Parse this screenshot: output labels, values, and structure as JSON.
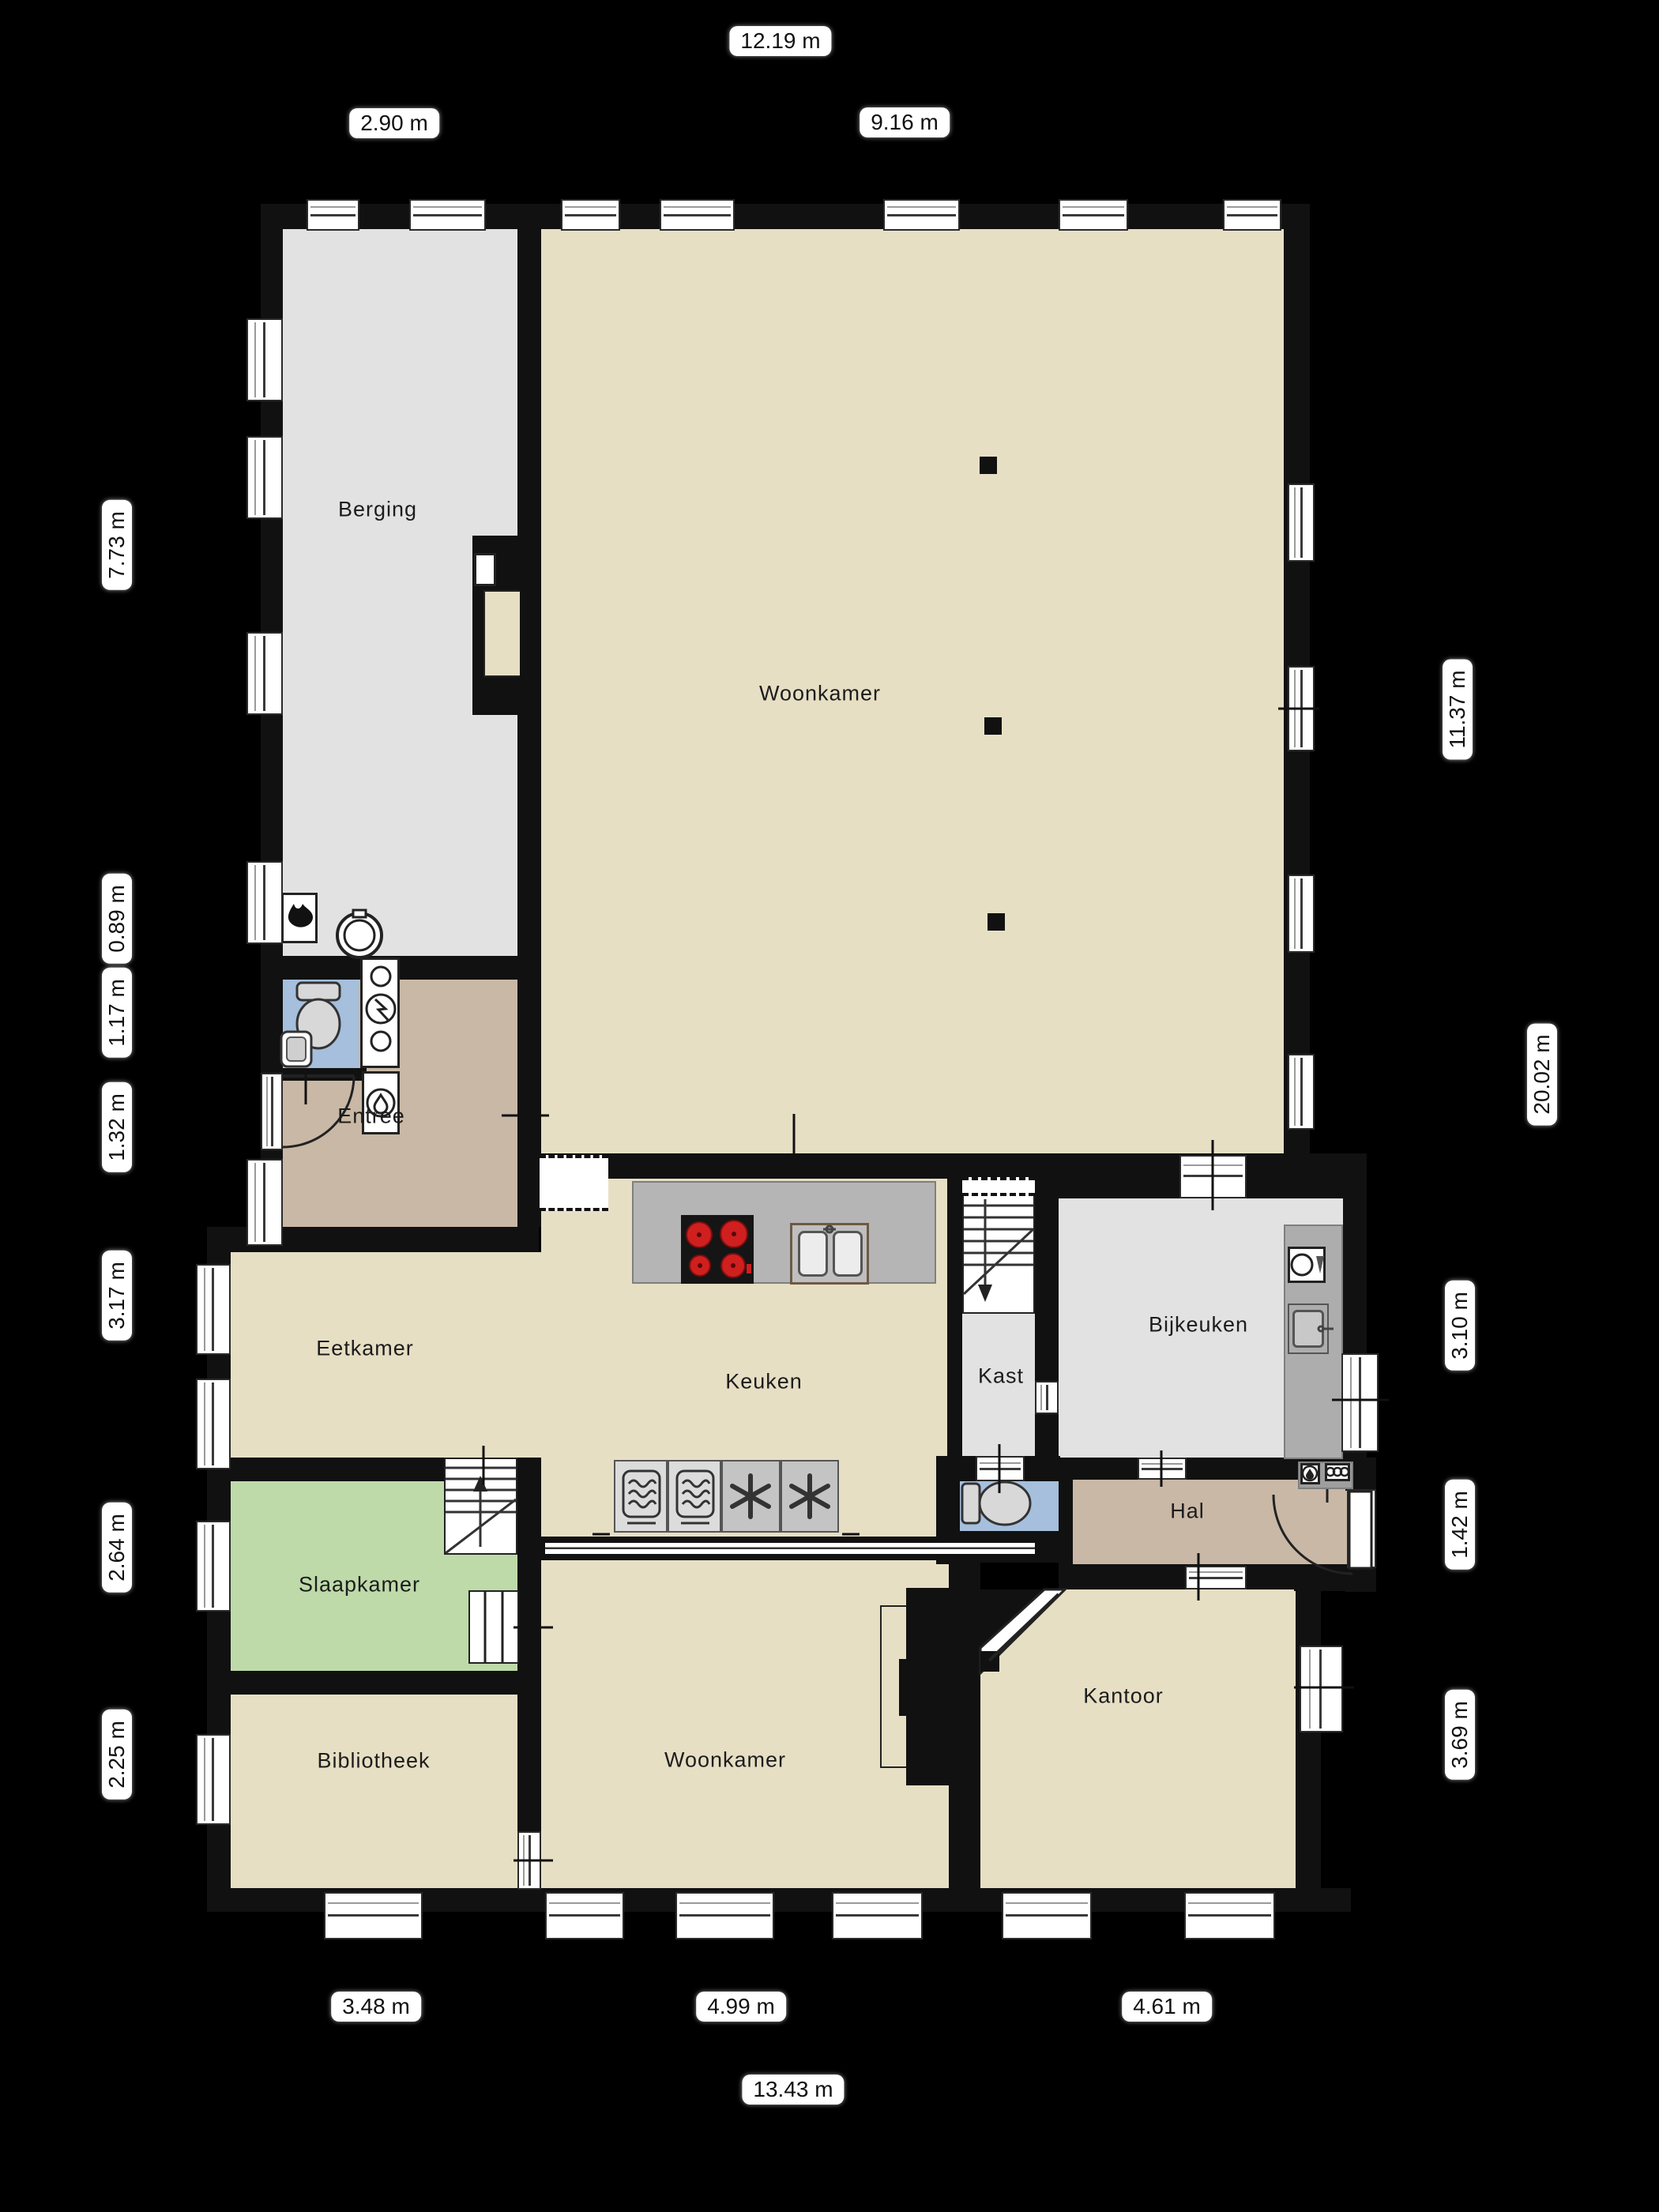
{
  "plan_type": "floorplan",
  "colors": {
    "background": "#000000",
    "floor_beige": "#e6dfc4",
    "floor_gray": "#e2e2e2",
    "floor_tan": "#c9b8a5",
    "floor_green": "#bedaa9",
    "floor_blue": "#a5bfdc",
    "wall_black": "#111111",
    "counter_gray": "#b5b5b5",
    "burner_red": "#cf1f1f",
    "window_white": "#ffffff"
  },
  "rooms": [
    {
      "label": "Berging"
    },
    {
      "label": "Woonkamer"
    },
    {
      "label": "Entree"
    },
    {
      "label": "Eetkamer"
    },
    {
      "label": "Keuken"
    },
    {
      "label": "Kast"
    },
    {
      "label": "Bijkeuken"
    },
    {
      "label": "Slaapkamer"
    },
    {
      "label": "Hal"
    },
    {
      "label": "Woonkamer"
    },
    {
      "label": "Kantoor"
    },
    {
      "label": "Bibliotheek"
    }
  ],
  "dimensions": {
    "top": [
      {
        "value": "12.19 m"
      },
      {
        "value": "2.90 m"
      },
      {
        "value": "9.16 m"
      }
    ],
    "left": [
      {
        "value": "7.73 m"
      },
      {
        "value": "0.89 m"
      },
      {
        "value": "1.17 m"
      },
      {
        "value": "1.32 m"
      },
      {
        "value": "3.17 m"
      },
      {
        "value": "2.64 m"
      },
      {
        "value": "2.25 m"
      }
    ],
    "right": [
      {
        "value": "11.37 m"
      },
      {
        "value": "20.02 m"
      },
      {
        "value": "3.10 m"
      },
      {
        "value": "1.42 m"
      },
      {
        "value": "3.69 m"
      }
    ],
    "bottom": [
      {
        "value": "3.48 m"
      },
      {
        "value": "4.99 m"
      },
      {
        "value": "4.61 m"
      },
      {
        "value": "13.43 m"
      }
    ]
  },
  "icons": [
    "stairs-up-icon",
    "stairs-down-icon",
    "cooktop-icon",
    "kitchen-sink-icon",
    "oven-icon",
    "freezer-icon",
    "washing-machine-icon",
    "boiler-flame-icon",
    "electric-meter-icon",
    "water-meter-icon",
    "toilet-icon",
    "hand-basin-icon",
    "water-heater-icon",
    "utility-sink-icon",
    "wardrobe-icon",
    "fireplace-icon",
    "door-swing-icon",
    "column-icon"
  ]
}
